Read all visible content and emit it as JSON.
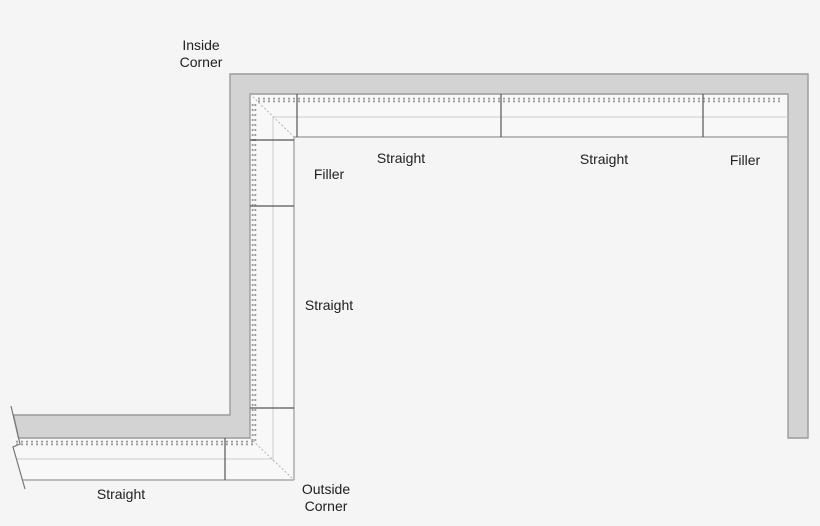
{
  "diagram": {
    "type": "trim-molding-layout-plan",
    "runs": {
      "top_wall_pieces": [
        "Inside Corner",
        "Straight",
        "Straight",
        "Filler"
      ],
      "left_wall_pieces": [
        "Inside Corner",
        "Filler",
        "Straight",
        "Outside Corner"
      ],
      "bottom_wall_pieces": [
        "Outside Corner",
        "Straight"
      ]
    },
    "colors": {
      "background": "#f5f5f5",
      "wall_fill": "#d3d3d3",
      "wall_border": "#9b9b9b",
      "piece_divider": "#555555",
      "molding_edge": "#999999",
      "molding_profile_light": "#cccccc",
      "bead_strip": "#9a9a9a",
      "miter_line": "#b3b3b3",
      "label_text": "#202020"
    }
  },
  "labels": {
    "inside_corner_line1": "Inside",
    "inside_corner_line2": "Corner",
    "top_straight_1": "Straight",
    "top_straight_2": "Straight",
    "top_filler": "Filler",
    "left_filler": "Filler",
    "left_straight": "Straight",
    "bottom_straight": "Straight",
    "outside_corner_line1": "Outside",
    "outside_corner_line2": "Corner"
  }
}
